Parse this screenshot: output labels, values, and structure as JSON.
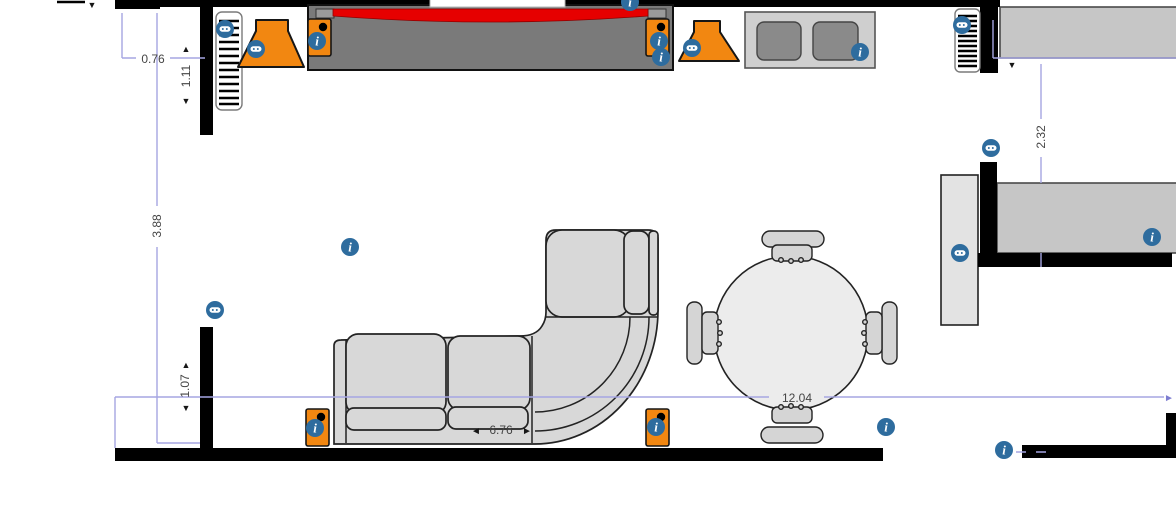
{
  "scene": {
    "type": "floor-plan-room-editor",
    "dimension_labels": {
      "top_offset_width": "0.76",
      "top_offset_height": "1.11",
      "left_wall_length": "3.88",
      "bottom_offset_height": "1.07",
      "sofa_width": "6.76",
      "room_width": "12.04",
      "right_wall_offset": "2.32"
    },
    "info_icon_glyph": "i",
    "arrow_glyphs": {
      "up": "▲",
      "down": "▼",
      "left": "◄",
      "right": "►"
    },
    "icons": {
      "info": "letter-i-in-blue-circle",
      "measure": "tape-measure-badge-in-blue-circle"
    }
  },
  "colors": {
    "wall": "#000000",
    "dimension_line": "#A6A6E2",
    "dimension_text": "#454545",
    "accent_orange": "#F28711",
    "info_badge_blue": "#2E6C9E",
    "screen_red": "#E60000",
    "sofa_gray": "#D8D8D8",
    "chair_gray": "#D5D5D5",
    "cabinet_gray": "#7A7A7A",
    "console_gray": "#CFCFCF",
    "console_door_gray": "#8A8A8A",
    "table_gray": "#ECECEC",
    "room2_gray": "#C6C6C6",
    "light_panel_gray": "#E3E3E3"
  }
}
